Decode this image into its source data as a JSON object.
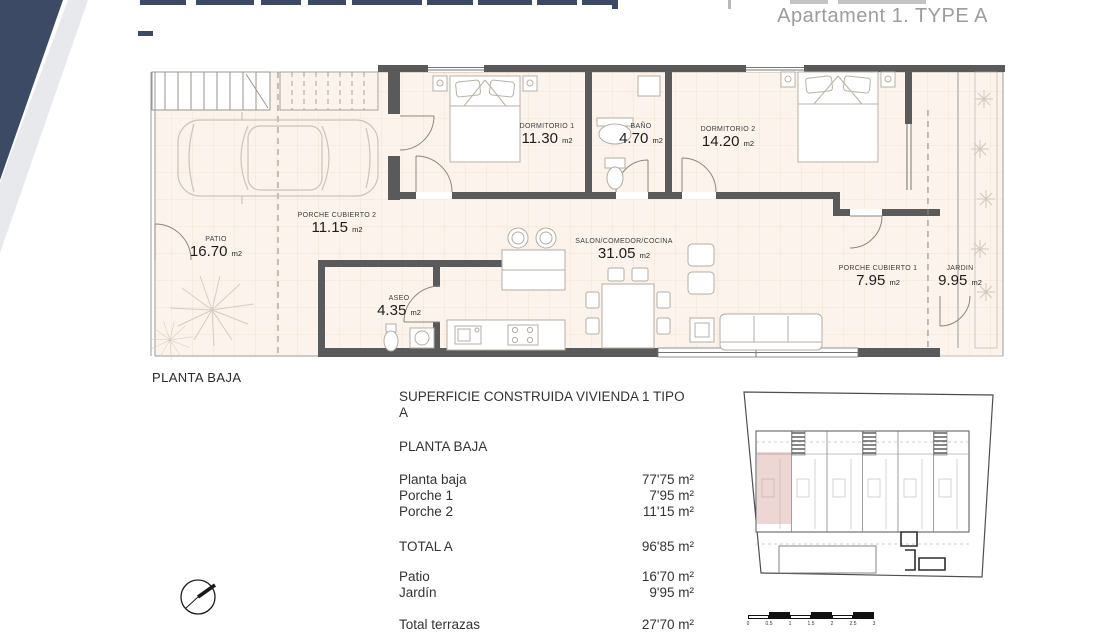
{
  "header": {
    "apartment_title": "Apartament 1. TYPE A"
  },
  "floor_plan": {
    "caption": "PLANTA BAJA",
    "area_unit": "m2",
    "rooms": [
      {
        "name": "DORMITORIO 1",
        "area": "11.30"
      },
      {
        "name": "BAÑO",
        "area": "4.70"
      },
      {
        "name": "DORMITORIO 2",
        "area": "14.20"
      },
      {
        "name": "PORCHE CUBIERTO 2",
        "area": "11.15"
      },
      {
        "name": "PATIO",
        "area": "16.70"
      },
      {
        "name": "SALON/COMEDOR/COCINA",
        "area": "31.05"
      },
      {
        "name": "ASEO",
        "area": "4.35"
      },
      {
        "name": "PORCHE CUBIERTO 1",
        "area": "7.95"
      },
      {
        "name": "JARDIN",
        "area": "9.95"
      }
    ]
  },
  "summary": {
    "title": "SUPERFICIE CONSTRUIDA VIVIENDA 1 TIPO A",
    "section": "PLANTA BAJA",
    "rows": [
      {
        "label": "Planta baja",
        "value": "77'75 m²"
      },
      {
        "label": "Porche 1",
        "value": "7'95 m²"
      },
      {
        "label": "Porche 2",
        "value": "11'15 m²"
      }
    ],
    "total": {
      "label": "TOTAL A",
      "value": "96'85 m²"
    },
    "terraces": [
      {
        "label": "Patio",
        "value": "16'70 m²"
      },
      {
        "label": "Jardín",
        "value": "9'95 m²"
      }
    ],
    "terrace_total": {
      "label": "Total terrazas",
      "value": "27'70 m²"
    }
  },
  "scale_bar": {
    "labels": [
      "0",
      "0.5",
      "1",
      "1.5",
      "2",
      "2.5",
      "3"
    ]
  },
  "colors": {
    "accent_navy": "#3c4a66",
    "title_gray": "#9c9c9c",
    "floor": "#fcf4ec",
    "wall": "#5a5a5a",
    "highlight_pink": "#eed6d4"
  }
}
